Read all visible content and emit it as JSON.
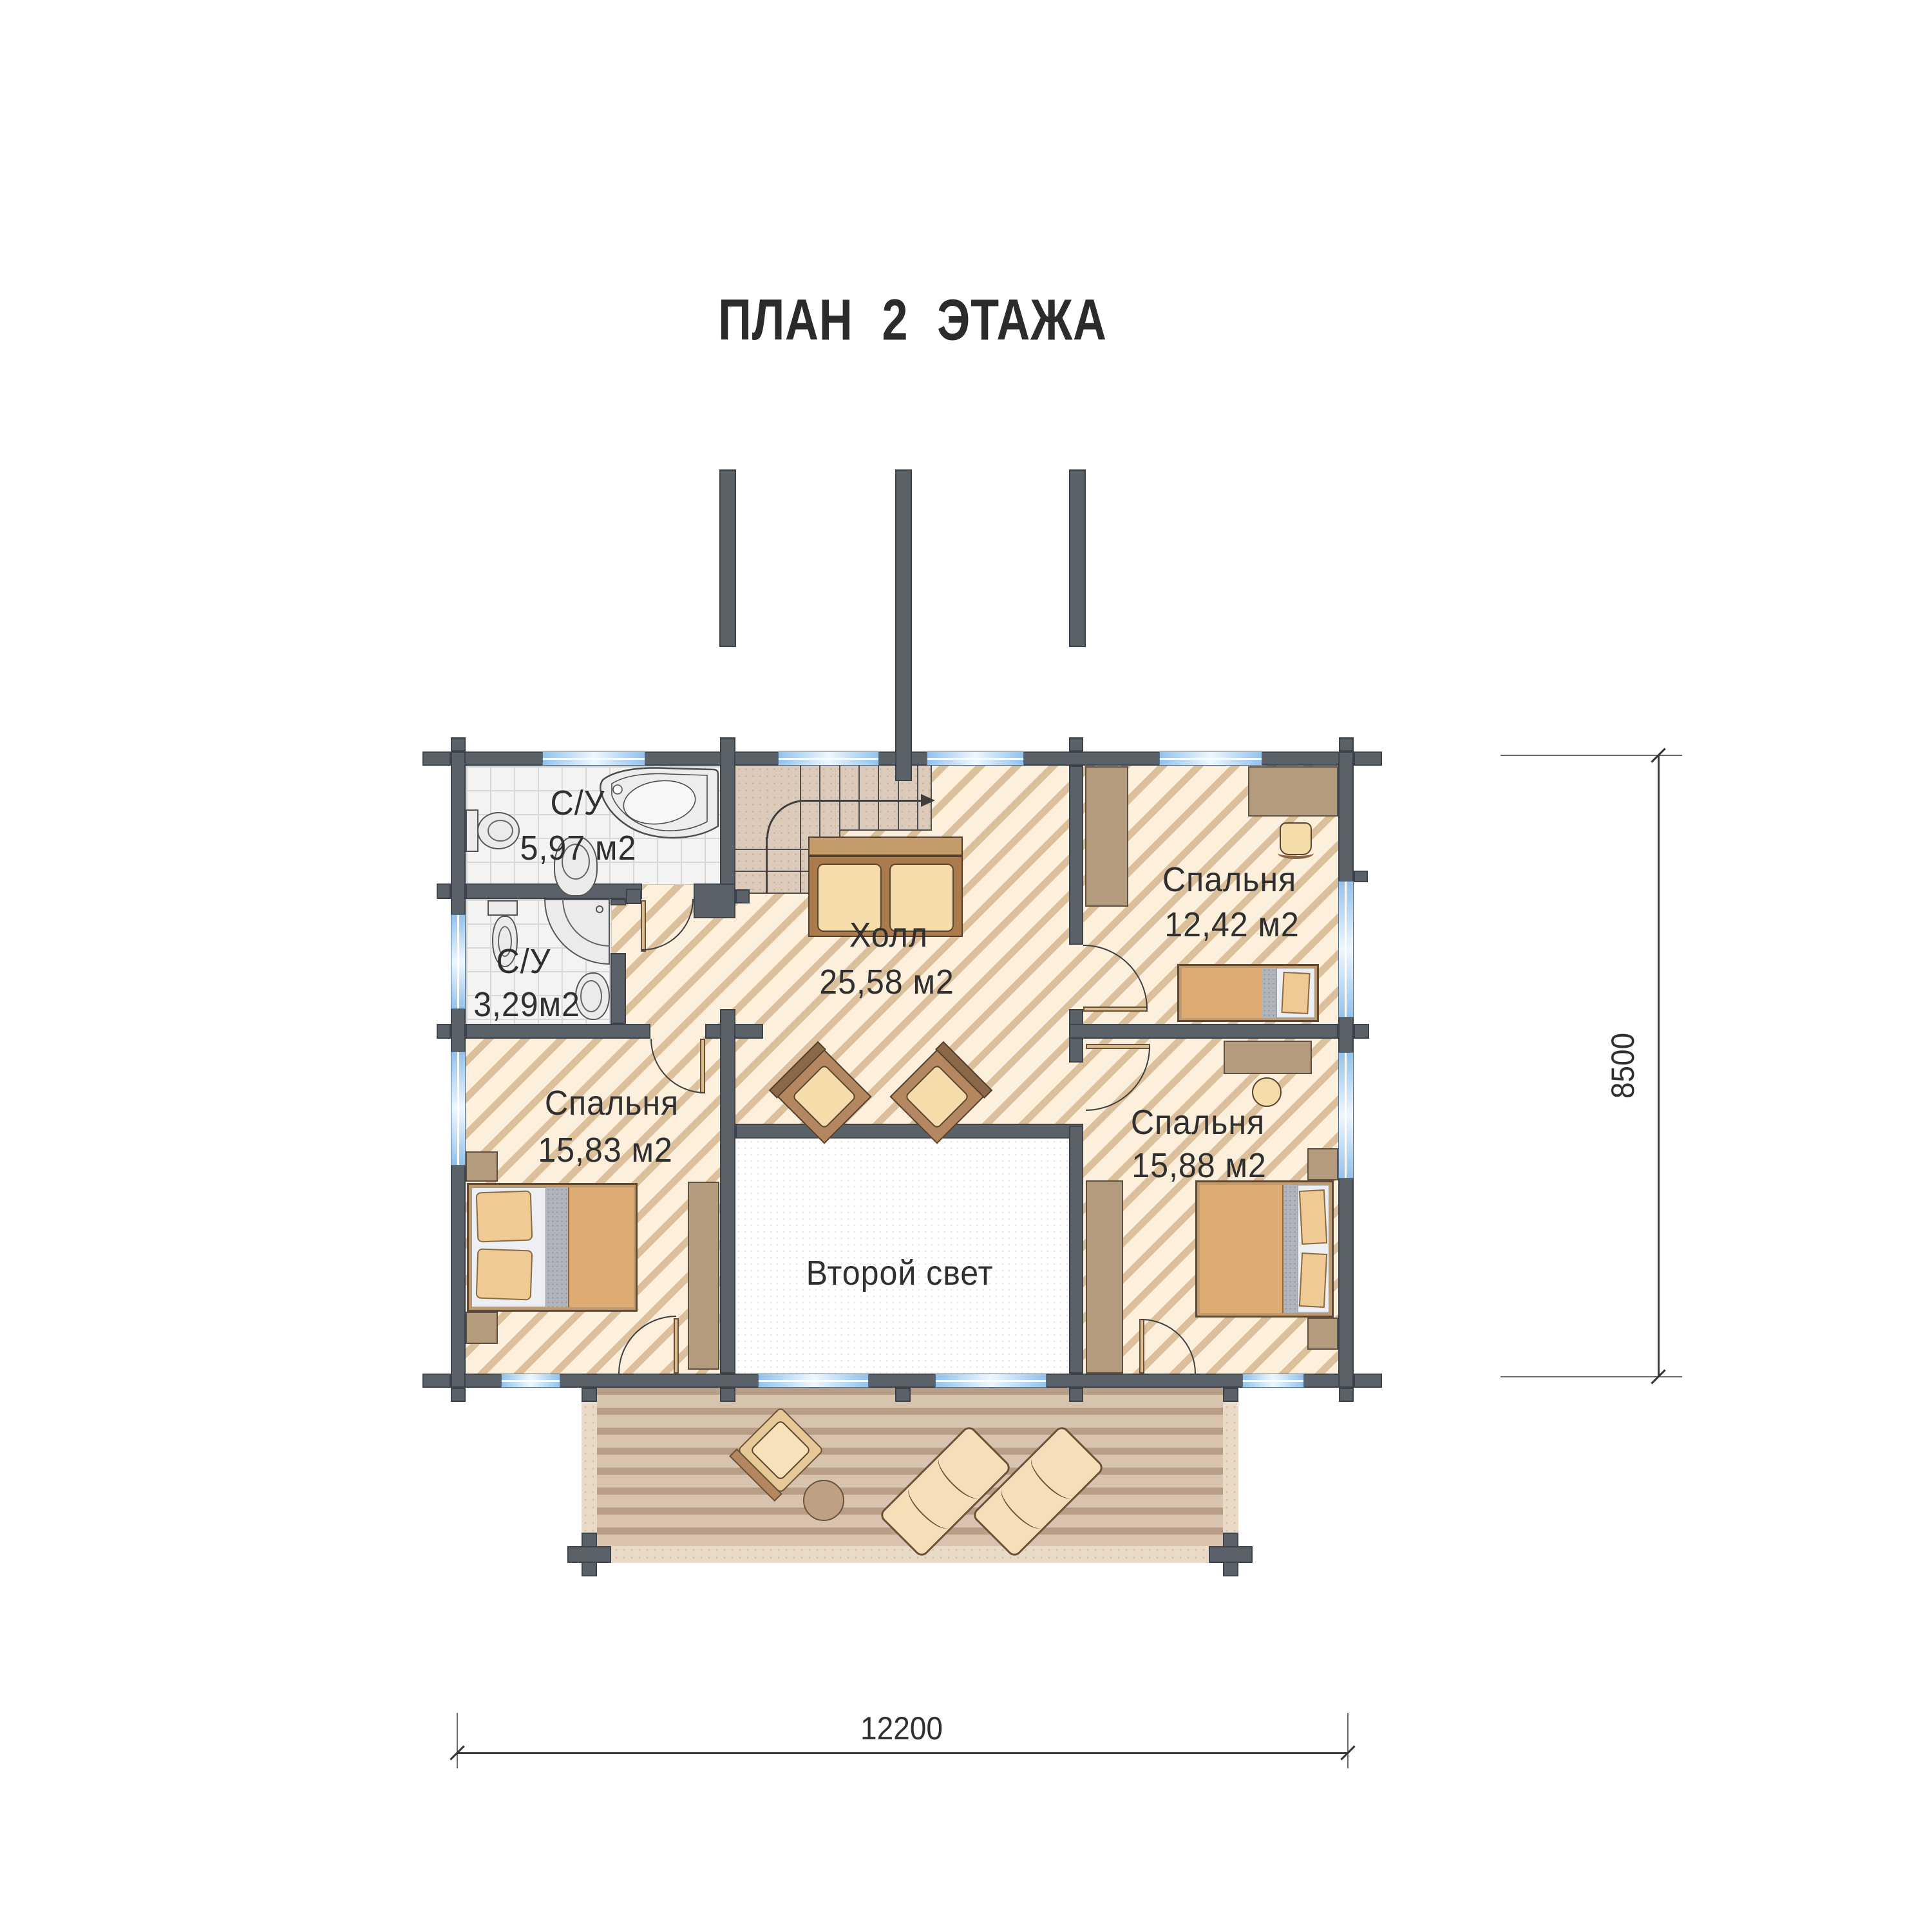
{
  "title": "ПЛАН 2 ЭТАЖА",
  "rooms": [
    {
      "id": "bathroom-1",
      "name": "С/У",
      "area": "5,97 м2"
    },
    {
      "id": "bathroom-2",
      "name": "С/У",
      "area": "3,29м2"
    },
    {
      "id": "hall",
      "name": "Холл",
      "area": "25,58 м2"
    },
    {
      "id": "bedroom-top-right",
      "name": "Спальня",
      "area": "12,42 м2"
    },
    {
      "id": "bedroom-left",
      "name": "Спальня",
      "area": "15,83 м2"
    },
    {
      "id": "bedroom-bottom-right",
      "name": "Спальня",
      "area": "15,88 м2"
    },
    {
      "id": "second-light",
      "name": "Второй свет",
      "area": ""
    }
  ],
  "dimensions": {
    "bottom": "12200",
    "right": "8500"
  },
  "colors": {
    "wall": "#5b6169",
    "window_blue": "#93c2ec",
    "floor_cream": "#fcefdc",
    "hatch_line": "#dcc09c",
    "wood": "#b59b7d",
    "deck": "#d8c3af",
    "blanket": "#deac72"
  }
}
